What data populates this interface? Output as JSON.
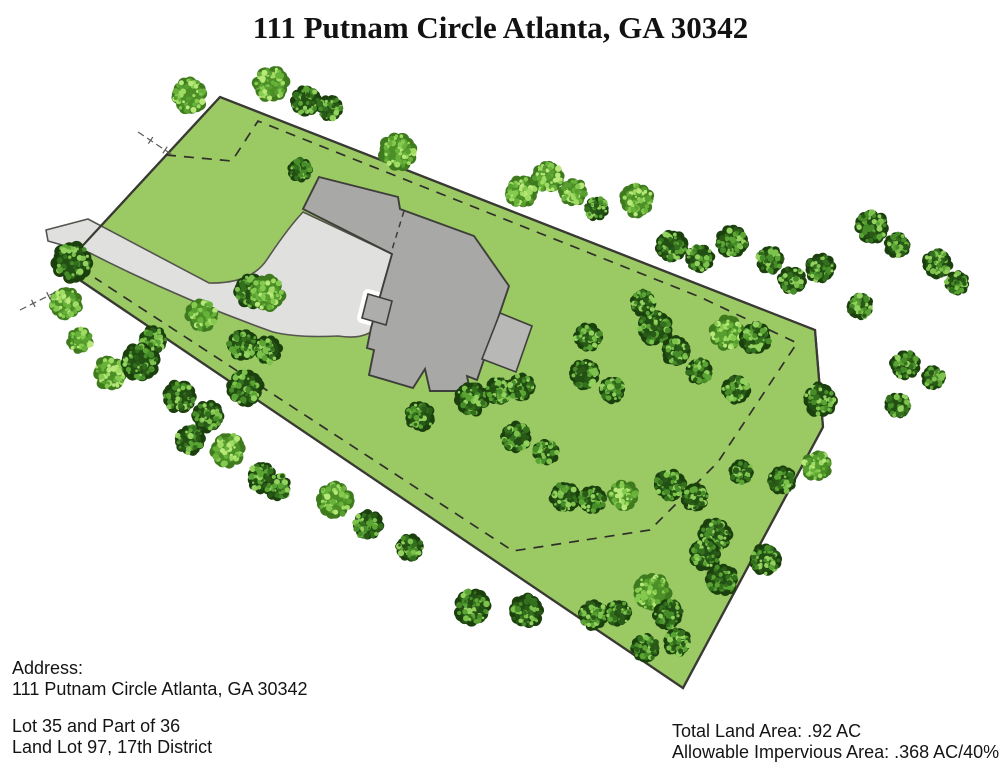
{
  "title": "111 Putnam Circle Atlanta, GA 30342",
  "footer": {
    "address_label": "Address:",
    "address_value": "111 Putnam Circle Atlanta, GA 30342",
    "lot_line1": "Lot 35 and Part of 36",
    "lot_line2": "Land Lot 97, 17th District",
    "total_land_area": "Total Land Area: .92 AC",
    "allowable_impervious": "Allowable Impervious Area: .368 AC/40%"
  },
  "colors": {
    "background": "#ffffff",
    "grass": "#9bc963",
    "boundary": "#3a3a35",
    "driveway_fill": "#e0e0de",
    "driveway_stroke": "#55554f",
    "house_main": "#a8a9a6",
    "house_wing": "#b8b9b6",
    "house_porch": "#adaeab",
    "house_stroke": "#3e3e3a",
    "dash_line": "#30302b",
    "tie_line": "#5a5a55"
  },
  "site_plan": {
    "parcel_points": [
      [
        220,
        97
      ],
      [
        815,
        330
      ],
      [
        823,
        427
      ],
      [
        683,
        688
      ],
      [
        62,
        268
      ]
    ],
    "setback_polyline": [
      [
        166,
        155
      ],
      [
        232,
        161
      ],
      [
        258,
        121
      ],
      [
        700,
        297
      ],
      [
        797,
        343
      ],
      [
        718,
        462
      ],
      [
        650,
        530
      ],
      [
        513,
        551
      ],
      [
        95,
        278
      ]
    ],
    "driveway_path": "M 46,230 L 88,219 Q 150,252 209,283 Q 252,284 268,258 Q 288,228 303,212 L 392,254 L 380,322 Q 370,341 338,336 Q 298,338 273,332 Q 180,299 90,253 L 48,241 Z",
    "house_main_points": [
      [
        319,
        177
      ],
      [
        398,
        197
      ],
      [
        400,
        209
      ],
      [
        474,
        236
      ],
      [
        509,
        286
      ],
      [
        477,
        380
      ],
      [
        467,
        376
      ],
      [
        470,
        391
      ],
      [
        430,
        391
      ],
      [
        425,
        369
      ],
      [
        413,
        388
      ],
      [
        369,
        375
      ],
      [
        374,
        350
      ],
      [
        367,
        348
      ],
      [
        371,
        328
      ],
      [
        392,
        254
      ],
      [
        303,
        209
      ]
    ],
    "house_wing_points": [
      [
        500,
        313
      ],
      [
        532,
        326
      ],
      [
        516,
        372
      ],
      [
        482,
        359
      ]
    ],
    "house_porch_points": [
      [
        368,
        294
      ],
      [
        392,
        301
      ],
      [
        386,
        325
      ],
      [
        362,
        318
      ]
    ],
    "house_divider": [
      [
        404,
        211
      ],
      [
        391,
        253
      ]
    ],
    "tie_lines": [
      {
        "x1": 138,
        "y1": 132,
        "x2": 174,
        "y2": 156
      },
      {
        "x1": 20,
        "y1": 310,
        "x2": 58,
        "y2": 291
      }
    ],
    "tree_palettes": {
      "d": {
        "edge": "#1b400e",
        "base": "#224f13",
        "dots": [
          "#33701d",
          "#468c28",
          "#5aa434",
          "#7dc24c",
          "#2a5a17",
          "#94d25f"
        ]
      },
      "l": {
        "edge": "#3f7a1f",
        "base": "#4b8f26",
        "dots": [
          "#68b23a",
          "#84ca4e",
          "#a0dc64",
          "#b8e87a",
          "#579f2f"
        ]
      }
    },
    "trees": [
      [
        190,
        96,
        18,
        "l"
      ],
      [
        271,
        84,
        18,
        "l"
      ],
      [
        306,
        101,
        15,
        "d"
      ],
      [
        330,
        108,
        13,
        "d"
      ],
      [
        398,
        151,
        19,
        "l"
      ],
      [
        300,
        170,
        12,
        "d"
      ],
      [
        521,
        192,
        16,
        "l"
      ],
      [
        548,
        177,
        16,
        "l"
      ],
      [
        573,
        192,
        14,
        "l"
      ],
      [
        597,
        209,
        12,
        "d"
      ],
      [
        637,
        200,
        17,
        "l"
      ],
      [
        672,
        246,
        16,
        "d"
      ],
      [
        700,
        258,
        14,
        "d"
      ],
      [
        732,
        242,
        16,
        "d"
      ],
      [
        770,
        260,
        14,
        "d"
      ],
      [
        792,
        280,
        14,
        "d"
      ],
      [
        820,
        268,
        15,
        "d"
      ],
      [
        872,
        227,
        17,
        "d"
      ],
      [
        897,
        245,
        13,
        "d"
      ],
      [
        937,
        264,
        15,
        "d"
      ],
      [
        957,
        283,
        12,
        "d"
      ],
      [
        860,
        306,
        13,
        "d"
      ],
      [
        905,
        365,
        15,
        "d"
      ],
      [
        933,
        378,
        12,
        "d"
      ],
      [
        898,
        405,
        13,
        "d"
      ],
      [
        727,
        333,
        17,
        "l"
      ],
      [
        755,
        338,
        16,
        "d"
      ],
      [
        736,
        390,
        14,
        "d"
      ],
      [
        699,
        371,
        13,
        "d"
      ],
      [
        820,
        400,
        17,
        "d"
      ],
      [
        588,
        337,
        14,
        "d"
      ],
      [
        584,
        374,
        15,
        "d"
      ],
      [
        612,
        390,
        13,
        "d"
      ],
      [
        655,
        328,
        18,
        "d"
      ],
      [
        643,
        303,
        13,
        "d"
      ],
      [
        676,
        351,
        15,
        "d"
      ],
      [
        252,
        291,
        18,
        "d"
      ],
      [
        202,
        315,
        16,
        "l"
      ],
      [
        243,
        345,
        16,
        "d"
      ],
      [
        268,
        350,
        14,
        "d"
      ],
      [
        267,
        293,
        18,
        "l"
      ],
      [
        72,
        262,
        20,
        "d"
      ],
      [
        66,
        303,
        16,
        "l"
      ],
      [
        80,
        340,
        13,
        "l"
      ],
      [
        153,
        340,
        14,
        "d"
      ],
      [
        110,
        373,
        17,
        "l"
      ],
      [
        140,
        362,
        19,
        "d"
      ],
      [
        180,
        397,
        17,
        "d"
      ],
      [
        208,
        416,
        16,
        "d"
      ],
      [
        245,
        388,
        18,
        "d"
      ],
      [
        190,
        440,
        15,
        "d"
      ],
      [
        228,
        450,
        17,
        "l"
      ],
      [
        262,
        478,
        15,
        "d"
      ],
      [
        277,
        487,
        14,
        "d"
      ],
      [
        335,
        500,
        18,
        "l"
      ],
      [
        368,
        525,
        15,
        "d"
      ],
      [
        410,
        548,
        14,
        "d"
      ],
      [
        472,
        607,
        18,
        "d"
      ],
      [
        527,
        611,
        17,
        "d"
      ],
      [
        593,
        615,
        15,
        "d"
      ],
      [
        618,
        613,
        13,
        "d"
      ],
      [
        652,
        592,
        19,
        "l"
      ],
      [
        668,
        614,
        15,
        "d"
      ],
      [
        645,
        648,
        14,
        "d"
      ],
      [
        677,
        642,
        14,
        "d"
      ],
      [
        472,
        399,
        17,
        "d"
      ],
      [
        499,
        391,
        14,
        "d"
      ],
      [
        521,
        387,
        14,
        "d"
      ],
      [
        420,
        416,
        15,
        "d"
      ],
      [
        516,
        437,
        15,
        "d"
      ],
      [
        546,
        452,
        13,
        "d"
      ],
      [
        565,
        497,
        15,
        "d"
      ],
      [
        592,
        500,
        14,
        "d"
      ],
      [
        623,
        495,
        15,
        "l"
      ],
      [
        670,
        485,
        16,
        "d"
      ],
      [
        695,
        497,
        14,
        "d"
      ],
      [
        715,
        535,
        17,
        "d"
      ],
      [
        741,
        472,
        12,
        "d"
      ],
      [
        765,
        560,
        16,
        "d"
      ],
      [
        705,
        555,
        16,
        "d"
      ],
      [
        722,
        580,
        16,
        "d"
      ],
      [
        817,
        466,
        15,
        "l"
      ],
      [
        782,
        480,
        14,
        "d"
      ]
    ]
  }
}
